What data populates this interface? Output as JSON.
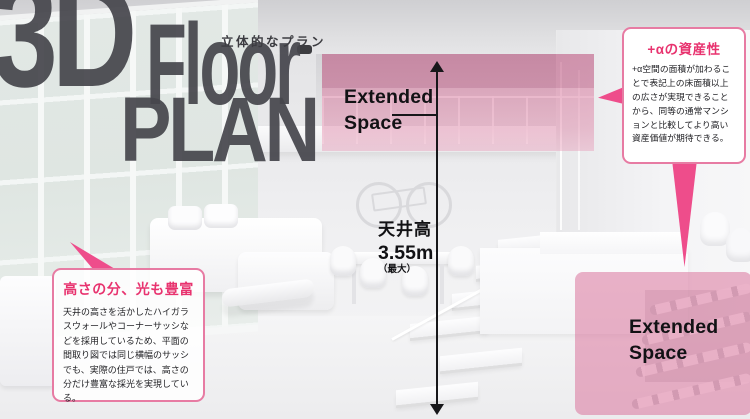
{
  "title": {
    "big": "3D",
    "floor": "Floor",
    "plan": "PLAN",
    "subtitle_jp": "立体的なプラン"
  },
  "overlays": {
    "loft_label": "Extended\nSpace",
    "closet_label": "Extended\nSpace"
  },
  "ceiling_height": {
    "label": "天井高",
    "value": "3.55m",
    "note": "（最大）"
  },
  "callouts": {
    "asset": {
      "title": "+αの資産性",
      "body": "+α空間の面積が加わることで表記上の床面積以上の広さが実現できることから、同等の通常マンションと比較してより高い資産価値が期待できる。"
    },
    "daylight": {
      "title": "高さの分、光も豊富",
      "body": "天井の高さを活かしたハイガラスウォールやコーナーサッシなどを採用しているため、平面の間取り図では同じ横幅のサッシでも、実際の住戸では、高さの分だけ豊富な採光を実現している。"
    }
  },
  "colors": {
    "accent_pink": "#e8336f",
    "spike_pink": "#ee4d8b",
    "callout_border_pink": "#e77ba3",
    "overlay_pink": "#db759c",
    "title_gray": "#46464c"
  }
}
